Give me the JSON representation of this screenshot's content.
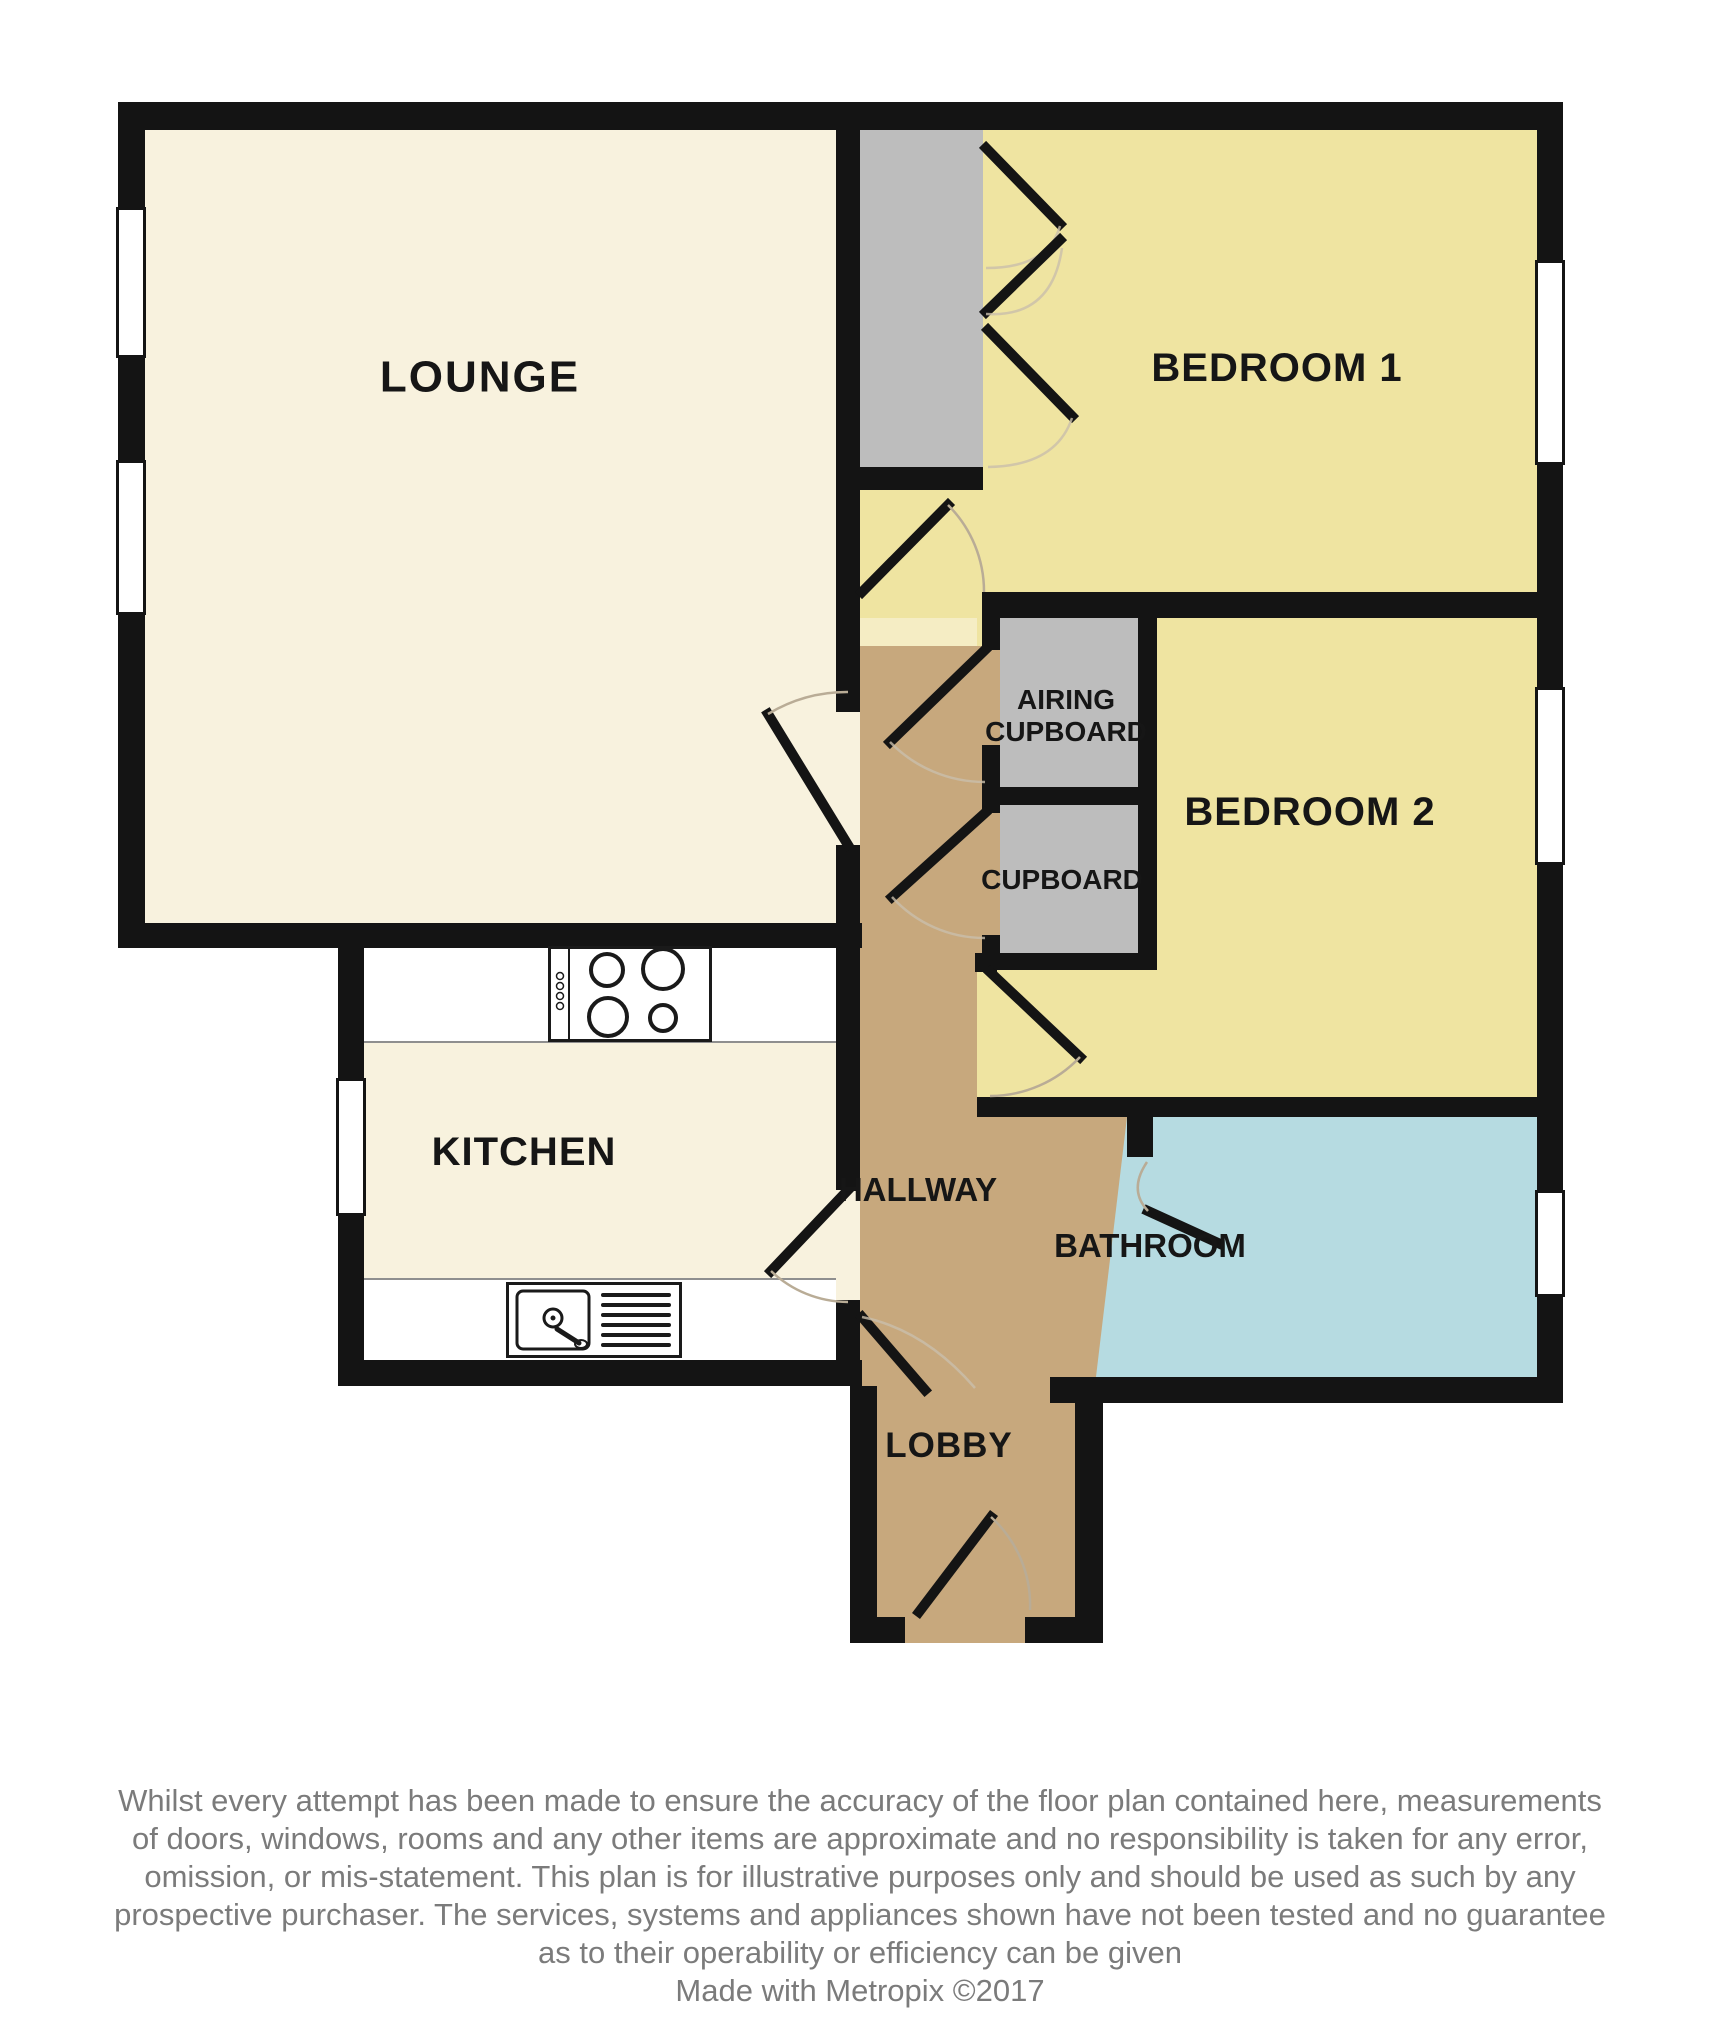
{
  "title": "Two bedroom flat floor plan",
  "colors": {
    "wall": "#141414",
    "cream": "#f8f2de",
    "yellow": "#efe4a1",
    "paleyellow": "#f5edc4",
    "tan": "#c7a87d",
    "gray": "#bdbdbd",
    "blue": "#b6dbe1",
    "labeltext": "#161616",
    "disc": "#7b7b7b"
  },
  "rooms": {
    "lounge": "LOUNGE",
    "bedroom1": "BEDROOM 1",
    "bedroom2": "BEDROOM 2",
    "kitchen": "KITCHEN",
    "hallway": "HALLWAY",
    "bathroom": "BATHROOM",
    "lobby": "LOBBY",
    "airing_line1": "AIRING",
    "airing_line2": "CUPBOARD",
    "cupboard": "CUPBOARD"
  },
  "fixtures": {
    "stove_icon": "four-burner-hob",
    "sink_icon": "sink-with-drainer"
  },
  "disclaimer": {
    "lines": [
      "Whilst every attempt has been made to ensure the accuracy of the floor plan contained here, measurements",
      "of doors, windows, rooms and any other items are approximate and no responsibility is taken for any error,",
      "omission, or mis-statement. This plan is for illustrative purposes only and should be used as such by any",
      "prospective purchaser. The services, systems and appliances shown have not been tested and no guarantee",
      "as to their operability or efficiency can be given"
    ]
  },
  "footer": "Made with Metropix ©2017"
}
